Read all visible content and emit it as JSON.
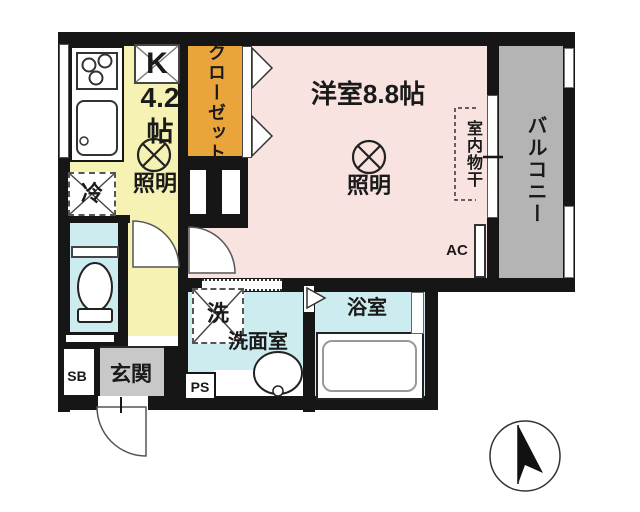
{
  "colors": {
    "wall": "#161616",
    "kitchen": "#f6f2b3",
    "closet": "#e9a43b",
    "room": "#f8e3e1",
    "balcony": "#b4b4b4",
    "wet": "#cdecf0",
    "entrance_floor": "#c8c8c8",
    "white": "#ffffff"
  },
  "labels": {
    "kitchen_type": "K",
    "kitchen_size": "4.2",
    "kitchen_unit": "帖",
    "closet": "クローゼット",
    "main_room": "洋室8.8帖",
    "lighting": "照明",
    "refrigerator": "冷",
    "indoor_drying": "室内物干",
    "balcony": "バルコニー",
    "ac": "AC",
    "washer": "洗",
    "washroom": "洗面室",
    "bathroom": "浴室",
    "entrance": "玄関",
    "shoe_box": "SB",
    "pipe_space": "PS"
  }
}
